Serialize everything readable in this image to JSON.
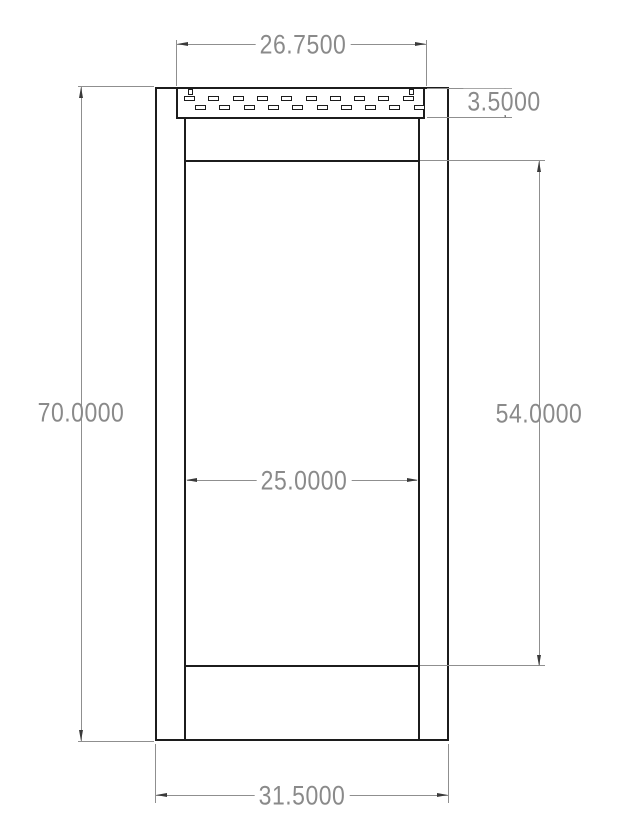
{
  "drawing": {
    "type": "dimensioned-elevation-louvered-door",
    "dimensions": {
      "louver_width": {
        "label": "26.7500",
        "value": 26.75,
        "orientation": "horizontal"
      },
      "louver_height": {
        "label": "3.5000",
        "value": 3.5,
        "orientation": "vertical"
      },
      "overall_height": {
        "label": "70.0000",
        "value": 70.0,
        "orientation": "vertical"
      },
      "opening_height": {
        "label": "54.0000",
        "value": 54.0,
        "orientation": "vertical"
      },
      "opening_width": {
        "label": "25.0000",
        "value": 25.0,
        "orientation": "horizontal"
      },
      "overall_width": {
        "label": "31.5000",
        "value": 31.5,
        "orientation": "horizontal"
      }
    },
    "louver_slats": {
      "rows": [
        {
          "y": 96,
          "start_x": 184,
          "count": 10,
          "pitch": 24.3
        },
        {
          "y": 105,
          "start_x": 195,
          "count": 10,
          "pitch": 24.3
        }
      ],
      "dash_width": 11,
      "dash_height": 5
    },
    "colors": {
      "object_line": "#1c1c1c",
      "dimension_line": "#8f8f8f",
      "dimension_text": "#8a8a8a",
      "arrow": "#3a3a3a",
      "background": "#ffffff"
    }
  }
}
